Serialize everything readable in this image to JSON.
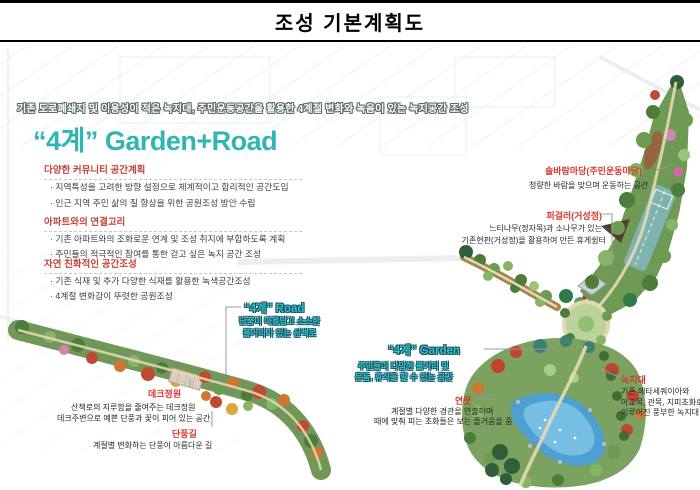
{
  "title": "조성 기본계획도",
  "banner": "기존 도로폐쇄지 및 이용성이 적은 녹지대, 주민운동공간을 활용한 4계절 변화와 녹음이 있는 녹지공간 조성",
  "concept_title": "“4계” Garden+Road",
  "panel": {
    "sections": [
      {
        "heading": "다양한 커뮤니티 공간계획",
        "bullets": [
          "· 지역특성을 고려한 방향 설정으로 체계적이고 합리적인 공간도입",
          "· 인근 지역 주민 삶의 질 향상을 위한 공원조성 방안 수립"
        ]
      },
      {
        "heading": "아파트와의 연결고리",
        "bullets": [
          "· 기존 아파트와의 조화로운 연계 및 조성 취지에 부합하도록 계획",
          "· 주민들의 적극적인 참여를 통한 걷고 싶은 녹지 공간 조성"
        ]
      },
      {
        "heading": "자연 친화적인 공간조성",
        "bullets": [
          "· 기존 식재 및 추가 다양한 식재를 활용한 녹색공간조성",
          "· 4계절 변화감이 뚜렷한 공원조성"
        ]
      }
    ]
  },
  "callouts": {
    "solbaram": {
      "label": "솔바람마당(주민운동마당)",
      "line1": "청량한 바람을 맞으며 운동하는 공간"
    },
    "pergola": {
      "label": "퍼걸러(거성정)",
      "line1": "느티나무(정자목)과 소나무가 있는",
      "line2": "기존현판(거성정)을 활용하여 만든 휴게쉼터"
    },
    "road": {
      "label": "“4계” Road",
      "line1": "단풍이 아름답고 소소한",
      "line2": "볼거리가 있는 산책로"
    },
    "garden": {
      "label": "“4계” Garden",
      "line1": "주민들이 다양한 볼거리 및",
      "line2": "운동, 휴식을 할 수 있는 공간"
    },
    "deck": {
      "label": "데크정원",
      "line1": "산책로의 지루함을 줄여주는 데크정원",
      "line2": "데크주변으로 예쁜 단풍과 꽃이 피어 있는 공간"
    },
    "maple": {
      "label": "단풍길",
      "line1": "계절별 변화하는 단풍이 아름다운 길"
    },
    "pond": {
      "label": "연못",
      "line1": "계절별 다양한 경관을 연출하며",
      "line2": "때에 맞춰 피는 초화들은 보는 즐거움을 줌"
    },
    "greenbelt": {
      "label": "녹지대",
      "line1": "기존 메타세쿼이아와",
      "line2": "아교목, 관목, 지피초화로",
      "line3": "이루어진 풍부한 녹지대 조성"
    }
  },
  "colors": {
    "accent_teal": "#2fb5b2",
    "accent_red": "#d6362b",
    "heading_red": "#c4443c"
  }
}
